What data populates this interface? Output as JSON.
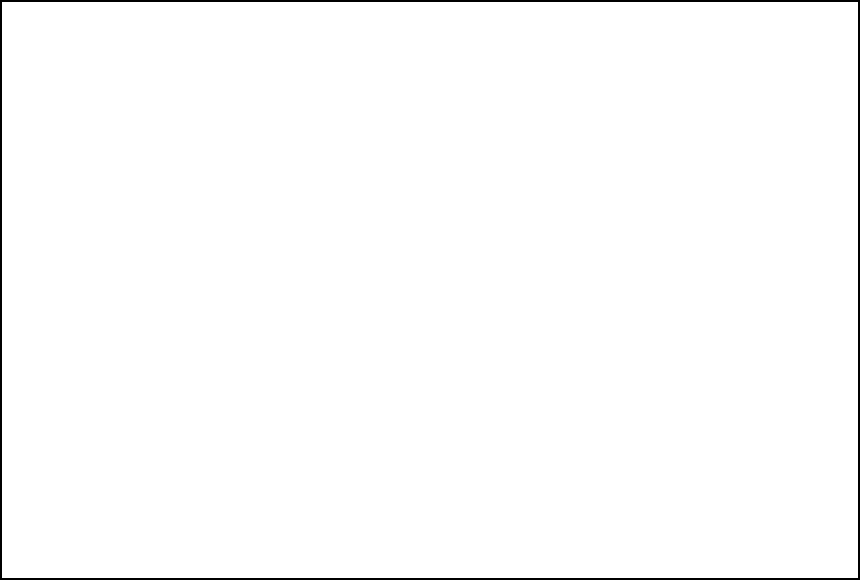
{
  "scene": {
    "description": "isometric 3d render of automated parcel sorting and palletizing line",
    "colors": {
      "bg": "#ffffff",
      "streak": "#f2f2f5",
      "streak2": "#f7f7f9",
      "shadow": "#e9e9ee",
      "white_frame": "#f3f3f6",
      "frame_stroke": "#d2d2d9",
      "frame_light": "#fbfbfd",
      "frame_mid": "#e3e3e9",
      "gray_side": "#c7c7cf",
      "leg_gray": "#b9b9c2",
      "belt_green": "#447964",
      "belt_green_dark": "#2f5d4a",
      "belt_green_light": "#55917a",
      "mint": "#5fc3a0",
      "roller_dark": "#6e6e78",
      "roller_mid": "#b5b5bf",
      "bridge_yellow": "#f8cb50",
      "bridge_yellow_light": "#fbe189",
      "bridge_rib": "#e5a93e",
      "bridge_shade": "#e2a83c",
      "bridge_dark": "#c98f2a",
      "robot_yellow": "#f0c337",
      "robot_shade": "#c99d20",
      "robot_joint": "#a8811b",
      "pedestal": "#cfcfd6",
      "base_plate": "#e5e5ea",
      "pallet_top": "#2f63b2",
      "pallet_light": "#4a80cc",
      "pallet_dark": "#1d3f7c",
      "pallet_edge": "#6f9bd9",
      "machine_dark": "#1d1d22",
      "machine_top": "#3d3d45",
      "red_dot": "#cd3a2e",
      "yellow_dot": "#e9b426",
      "blue_dot": "#3a6fd8",
      "border": "#000000"
    },
    "background_streaks": {
      "x": 55,
      "y": 62,
      "w": 700,
      "h": 424
    },
    "ghost_shadows": [
      [
        700,
        246,
        34,
        8
      ],
      [
        752,
        311,
        72,
        6
      ],
      [
        741,
        344,
        88,
        6
      ],
      [
        714,
        229,
        34,
        6
      ],
      [
        762,
        225,
        60,
        5
      ],
      [
        744,
        388,
        62,
        5
      ]
    ],
    "lattice": {
      "lane_count": 10,
      "lane_top_origin": [
        118,
        268
      ],
      "lane_top_step": [
        47,
        -16.8
      ],
      "lane_angle_deg": 50,
      "lane_lengths": [
        243,
        238,
        233,
        228,
        223,
        218,
        213,
        208,
        203,
        198
      ],
      "spine_angle_deg": -18.5,
      "spine_offsets_v": [
        2,
        62,
        122,
        182
      ],
      "spine_length": 535,
      "spine_pre_extend": 55
    },
    "inspection_machines": {
      "positions": [
        [
          530,
          140
        ],
        [
          545,
          168
        ]
      ],
      "angle_deg": -13.5,
      "length": 150
    },
    "top_transfer": {
      "start": [
        541,
        95
      ],
      "angle_deg": 5,
      "length": 117
    },
    "loop_sorter": {
      "start": [
        655,
        106
      ],
      "angle_deg": 35,
      "length": 148,
      "upper_chute_t": [
        28,
        60,
        92,
        124
      ],
      "lower_chute_t": [
        44,
        76,
        108,
        140
      ],
      "far_chute_t": [
        108,
        140
      ],
      "dot_t": [
        40,
        72,
        104
      ]
    },
    "maintenance_platform": {
      "origin": [
        610,
        186
      ]
    },
    "cabinet_big": {
      "x": 75,
      "y": 302,
      "w": 58,
      "h": 68,
      "depth": 14
    },
    "mint_cabinets": [
      [
        108,
        314
      ],
      [
        158,
        322
      ]
    ],
    "belt_loop_left": {
      "origin": [
        133,
        312
      ],
      "u_len": 172,
      "v_len": 58,
      "angle_u_deg": -12,
      "angle_v_deg": 62,
      "belt_width": 12
    },
    "bridge": {
      "start": [
        287,
        449
      ],
      "angle_deg": -25.8,
      "length": 458
    },
    "outfeeds": {
      "starts": [
        [
          347,
          436
        ],
        [
          406,
          408
        ],
        [
          464,
          379
        ],
        [
          523,
          351
        ],
        [
          581,
          323
        ],
        [
          640,
          295
        ]
      ],
      "angle_deg": 50,
      "lengths": [
        110,
        106,
        98,
        92,
        86,
        78
      ]
    },
    "robots": [
      [
        456,
        445
      ],
      [
        572,
        383
      ],
      [
        676,
        325
      ]
    ],
    "robot_scale": 0.78,
    "pallets": [
      [
        433,
        470,
        42
      ],
      [
        468,
        478,
        42
      ],
      [
        492,
        435,
        24
      ],
      [
        543,
        408,
        40
      ],
      [
        578,
        414,
        40
      ],
      [
        604,
        372,
        30
      ],
      [
        657,
        346,
        40
      ],
      [
        690,
        350,
        40
      ],
      [
        694,
        322,
        34
      ],
      [
        716,
        320,
        34
      ]
    ],
    "pallet_size": 40
  }
}
